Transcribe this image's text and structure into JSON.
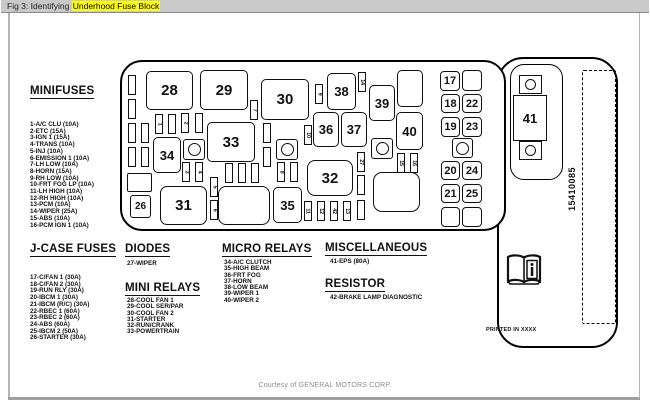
{
  "window": {
    "title_prefix": "Fig 3: Identifying ",
    "title_highlight": "Underhood Fuse Block"
  },
  "colors": {
    "titlebar_bg": "#c9c9c9",
    "highlight": "#ffff00",
    "ink": "#111111",
    "frame_line": "#b5b5b5",
    "courtesy_text": "#8c8c8c"
  },
  "legend": {
    "minifuses": {
      "heading": "MINIFUSES",
      "items": [
        "1-A/C CLU (10A)",
        "2-ETC (15A)",
        "3-IGN 1 (15A)",
        "4-TRANS (10A)",
        "5-INJ (10A)",
        "6-EMISSION 1 (10A)",
        "7-LH LOW (10A)",
        "8-HORN (15A)",
        "9-RH LOW (10A)",
        "10-FRT FOG LP (10A)",
        "11-LH HIGH (10A)",
        "12-RH HIGH (10A)",
        "13-PCM (10A)",
        "14-WIPER (25A)",
        "15-ABS (10A)",
        "16-PCM IGN 1 (10A)"
      ]
    },
    "j_case_fuses": {
      "heading": "J-CASE FUSES",
      "items": [
        "17-C/FAN 1 (30A)",
        "18-C/FAN 2 (30A)",
        "19-RUN RLY (30A)",
        "20-IBCM 1 (30A)",
        "21-IBCM (R/C) (30A)",
        "22-RBEC 1 (60A)",
        "23-RBEC 2 (60A)",
        "24-ABS (60A)",
        "25-IBCM 2 (50A)",
        "26-STARTER (30A)"
      ]
    },
    "diodes": {
      "heading": "DIODES",
      "items": [
        "27-WIPER"
      ]
    },
    "mini_relays": {
      "heading": "MINI RELAYS",
      "items": [
        "28-COOL FAN 1",
        "29-COOL SER/PAR",
        "30-COOL FAN 2",
        "31-STARTER",
        "32-RUN/CRANK",
        "33-POWERTRAIN"
      ]
    },
    "micro_relays": {
      "heading": "MICRO RELAYS",
      "items": [
        "34-A/C CLUTCH",
        "35-HIGH BEAM",
        "36-FRT FOG",
        "37-HORN",
        "38-LOW BEAM",
        "39-WIPER 1",
        "40-WIPER 2"
      ]
    },
    "miscellaneous": {
      "heading": "MISCELLANEOUS",
      "items": [
        "41-EPS (80A)"
      ]
    },
    "resistor": {
      "heading": "RESISTOR",
      "items": [
        "42-BRAKE LAMP DIAGNOSTIC"
      ]
    }
  },
  "diagram": {
    "mega_fuse": {
      "label": "41"
    },
    "part_number": "15410085",
    "printed_note": "PRINTED IN XXXX",
    "relays": [
      {
        "label": "28",
        "x": 146,
        "y": 71,
        "w": 47,
        "h": 39
      },
      {
        "label": "29",
        "x": 200,
        "y": 70,
        "w": 48,
        "h": 40
      },
      {
        "label": "30",
        "x": 261,
        "y": 79,
        "w": 48,
        "h": 41
      },
      {
        "label": "38",
        "x": 327,
        "y": 73,
        "w": 29,
        "h": 37
      },
      {
        "label": "39",
        "x": 369,
        "y": 85,
        "w": 26,
        "h": 36
      },
      {
        "label": "",
        "x": 397,
        "y": 70,
        "w": 26,
        "h": 37
      },
      {
        "label": "36",
        "x": 313,
        "y": 112,
        "w": 26,
        "h": 35
      },
      {
        "label": "37",
        "x": 341,
        "y": 112,
        "w": 26,
        "h": 35
      },
      {
        "label": "40",
        "x": 396,
        "y": 112,
        "w": 27,
        "h": 38
      },
      {
        "label": "33",
        "x": 207,
        "y": 122,
        "w": 48,
        "h": 40
      },
      {
        "label": "34",
        "x": 153,
        "y": 137,
        "w": 28,
        "h": 36
      },
      {
        "label": "32",
        "x": 307,
        "y": 160,
        "w": 46,
        "h": 36,
        "r": 8
      },
      {
        "label": "31",
        "x": 160,
        "y": 186,
        "w": 47,
        "h": 39,
        "r": 7
      },
      {
        "label": "",
        "x": 218,
        "y": 186,
        "w": 52,
        "h": 39,
        "r": 8
      },
      {
        "label": "35",
        "x": 273,
        "y": 187,
        "w": 29,
        "h": 36
      },
      {
        "label": "",
        "x": 373,
        "y": 172,
        "w": 47,
        "h": 40,
        "r": 9
      },
      {
        "label": "26",
        "x": 130,
        "y": 195,
        "w": 21,
        "h": 23,
        "r": 3
      },
      {
        "label": "",
        "x": 127,
        "y": 173,
        "w": 25,
        "h": 19,
        "r": 2
      }
    ],
    "jcase_slots": [
      {
        "label": "17",
        "x": 440,
        "y": 71,
        "w": 20,
        "h": 20
      },
      {
        "label": "",
        "x": 462,
        "y": 70,
        "w": 20,
        "h": 21
      },
      {
        "label": "18",
        "x": 441,
        "y": 94,
        "w": 19,
        "h": 19
      },
      {
        "label": "22",
        "x": 462,
        "y": 94,
        "w": 20,
        "h": 19
      },
      {
        "label": "19",
        "x": 441,
        "y": 117,
        "w": 19,
        "h": 20
      },
      {
        "label": "23",
        "x": 462,
        "y": 117,
        "w": 20,
        "h": 20
      },
      {
        "label": "20",
        "x": 441,
        "y": 161,
        "w": 19,
        "h": 19
      },
      {
        "label": "24",
        "x": 462,
        "y": 161,
        "w": 20,
        "h": 19
      },
      {
        "label": "21",
        "x": 441,
        "y": 184,
        "w": 19,
        "h": 19
      },
      {
        "label": "25",
        "x": 462,
        "y": 184,
        "w": 20,
        "h": 19
      },
      {
        "label": "",
        "x": 441,
        "y": 207,
        "w": 19,
        "h": 20
      },
      {
        "label": "",
        "x": 462,
        "y": 207,
        "w": 20,
        "h": 20
      }
    ],
    "round_slots": [
      {
        "x": 183,
        "y": 139,
        "w": 22,
        "h": 21
      },
      {
        "x": 276,
        "y": 139,
        "w": 22,
        "h": 21
      },
      {
        "x": 371,
        "y": 138,
        "w": 22,
        "h": 21
      },
      {
        "x": 452,
        "y": 138,
        "w": 21,
        "h": 20
      }
    ],
    "small_fuses": [
      {
        "label": "",
        "x": 128,
        "y": 75
      },
      {
        "label": "",
        "x": 128,
        "y": 99
      },
      {
        "label": "",
        "x": 128,
        "y": 123
      },
      {
        "label": "",
        "x": 128,
        "y": 147
      },
      {
        "label": "",
        "x": 141,
        "y": 123
      },
      {
        "label": "",
        "x": 141,
        "y": 147
      },
      {
        "label": "1",
        "x": 155,
        "y": 114
      },
      {
        "label": "",
        "x": 168,
        "y": 114
      },
      {
        "label": "2",
        "x": 181,
        "y": 113
      },
      {
        "label": "",
        "x": 195,
        "y": 113
      },
      {
        "label": "7",
        "x": 250,
        "y": 100
      },
      {
        "label": "3",
        "x": 182,
        "y": 162
      },
      {
        "label": "4",
        "x": 195,
        "y": 162
      },
      {
        "label": "",
        "x": 225,
        "y": 163
      },
      {
        "label": "",
        "x": 238,
        "y": 163
      },
      {
        "label": "",
        "x": 251,
        "y": 163
      },
      {
        "label": "5",
        "x": 210,
        "y": 177
      },
      {
        "label": "6",
        "x": 210,
        "y": 200
      },
      {
        "label": "8",
        "x": 277,
        "y": 162
      },
      {
        "label": "",
        "x": 290,
        "y": 162
      },
      {
        "label": "",
        "x": 263,
        "y": 123
      },
      {
        "label": "",
        "x": 263,
        "y": 147
      },
      {
        "label": "10",
        "x": 304,
        "y": 125
      },
      {
        "label": "9",
        "x": 315,
        "y": 84
      },
      {
        "label": "14",
        "x": 358,
        "y": 72
      },
      {
        "label": "27",
        "x": 357,
        "y": 152
      },
      {
        "label": "",
        "x": 357,
        "y": 175
      },
      {
        "label": "15",
        "x": 397,
        "y": 153
      },
      {
        "label": "16",
        "x": 410,
        "y": 153
      },
      {
        "label": "11",
        "x": 304,
        "y": 201
      },
      {
        "label": "12",
        "x": 317,
        "y": 201
      },
      {
        "label": "42",
        "x": 330,
        "y": 201
      },
      {
        "label": "13",
        "x": 343,
        "y": 201
      },
      {
        "label": "",
        "x": 357,
        "y": 200
      }
    ]
  },
  "footer": {
    "courtesy": "Courtesy of GENERAL MOTORS CORP."
  }
}
